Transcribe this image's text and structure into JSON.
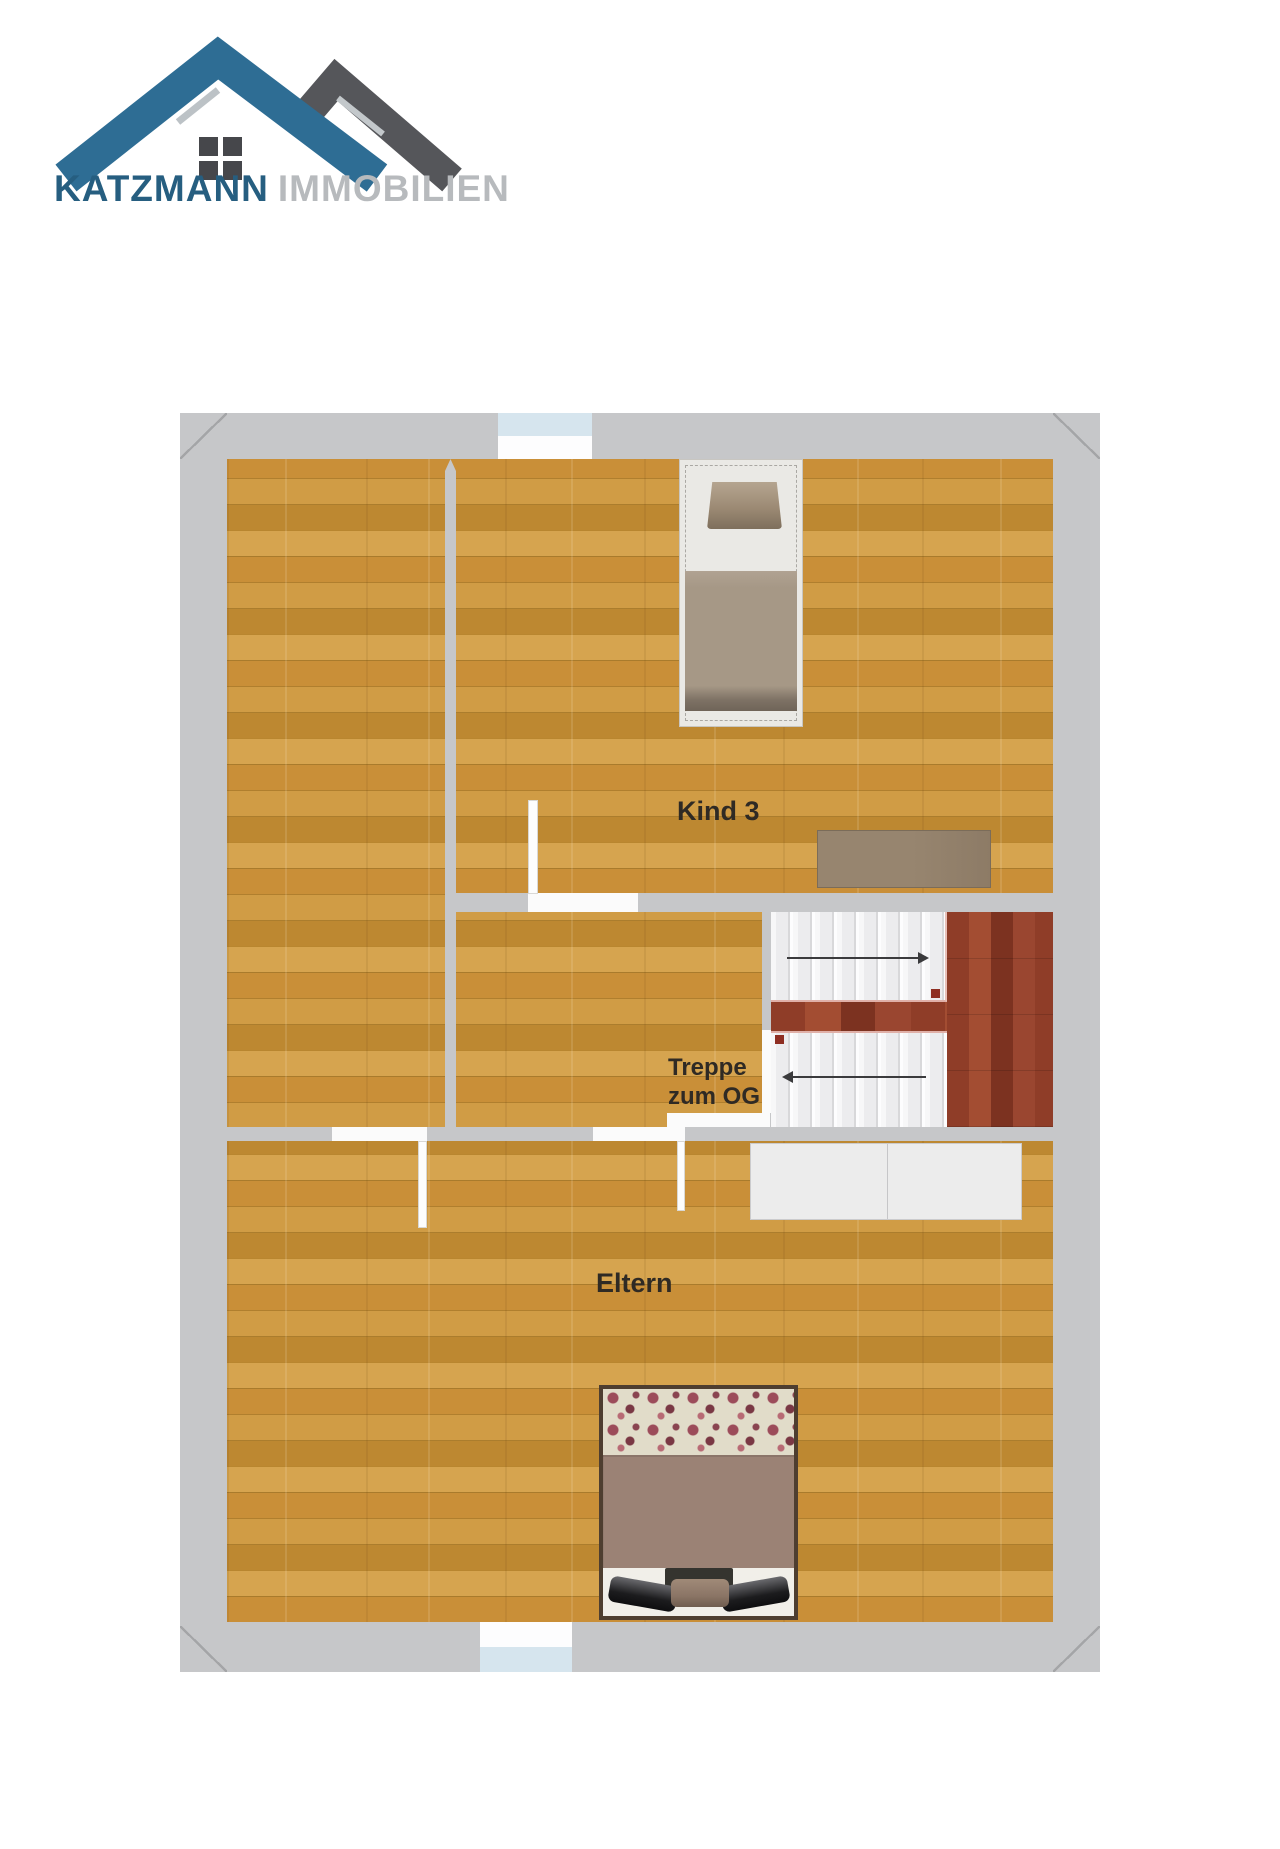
{
  "logo": {
    "brand": "KATZMANN",
    "type": "IMMOBILIEN"
  },
  "plan": {
    "rooms": {
      "kind3": {
        "label": "Kind 3"
      },
      "stair_hall": {
        "label_line1": "Treppe",
        "label_line2": "zum OG"
      },
      "eltern": {
        "label": "Eltern"
      }
    },
    "furniture": [
      {
        "name": "single-bed",
        "room": "kind3"
      },
      {
        "name": "desk",
        "room": "kind3"
      },
      {
        "name": "wardrobe",
        "room": "eltern"
      },
      {
        "name": "double-bed",
        "room": "eltern"
      }
    ],
    "stairs": {
      "up_flight_icon": "arrow-right",
      "down_flight_icon": "arrow-left"
    },
    "colors": {
      "wall_gray": "#c6c7c9",
      "floor_wood": "#cc9641",
      "stair_landing_wood": "#8f3d28",
      "window_glass": "#d6e5ee",
      "logo_roof_blue": "#2e6d94",
      "logo_roof_gray": "#55565a",
      "logo_text_blue": "#265e80",
      "logo_text_gray": "#b7babd"
    }
  }
}
